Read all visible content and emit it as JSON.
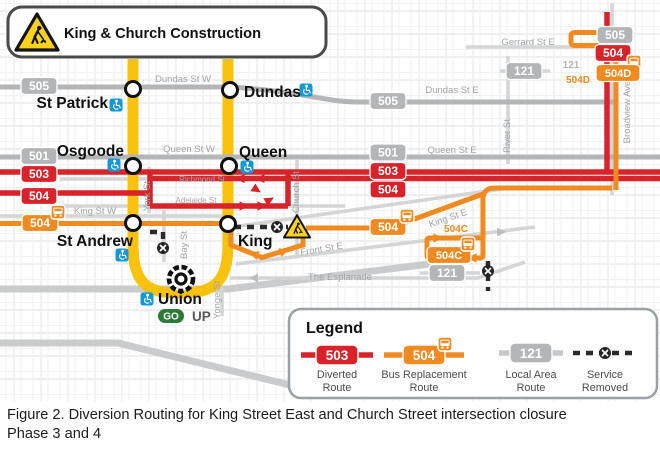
{
  "banner": {
    "title": "King & Church Construction"
  },
  "routes": {
    "r501": "501",
    "r503": "503",
    "r504": "504",
    "r505": "505",
    "r121": "121",
    "r504C": "504C",
    "r504D": "504D"
  },
  "stations": {
    "st_patrick": "St Patrick",
    "osgoode": "Osgoode",
    "st_andrew": "St Andrew",
    "union": "Union",
    "dundas": "Dundas",
    "queen": "Queen",
    "king": "King"
  },
  "union_services": {
    "go": "GO",
    "up": "UP"
  },
  "streets": {
    "dundas_w": "Dundas St W",
    "dundas_e": "Dundas St E",
    "queen_w": "Queen St W",
    "queen_e": "Queen St E",
    "king_w": "King St W",
    "king_e": "King St E",
    "gerrard_e": "Gerrard St E",
    "front_e": "Front St E",
    "esplanade": "The Esplanade",
    "richmond": "Richmond St",
    "adelaide": "Adelaide St",
    "church": "Church St",
    "yonge": "Yonge St",
    "york": "York St",
    "bay": "Bay St",
    "river": "River St",
    "broadview": "Broadview Ave"
  },
  "legend": {
    "title": "Legend",
    "items": [
      {
        "route": "503",
        "line1": "Diverted",
        "line2": "Route",
        "type": "diverted"
      },
      {
        "route": "504",
        "line1": "Bus Replacement",
        "line2": "Route",
        "type": "bus-replacement"
      },
      {
        "route": "121",
        "line1": "Local Area",
        "line2": "Route",
        "type": "local-area"
      },
      {
        "route": "",
        "line1": "Service",
        "line2": "Removed",
        "type": "service-removed"
      }
    ]
  },
  "caption": {
    "line1": "Figure 2. Diversion Routing for King Street East and Church Street intersection closure",
    "line2": "Phase 3 and 4"
  },
  "colors": {
    "diverted_red": "#D8232A",
    "replacement_orange": "#F08A21",
    "local_gray": "#B3B5B7",
    "subway_yellow": "#F8C20D",
    "accessible_blue": "#1599D6",
    "go_green": "#2C7A35",
    "warning_yellow": "#FFD21E"
  }
}
